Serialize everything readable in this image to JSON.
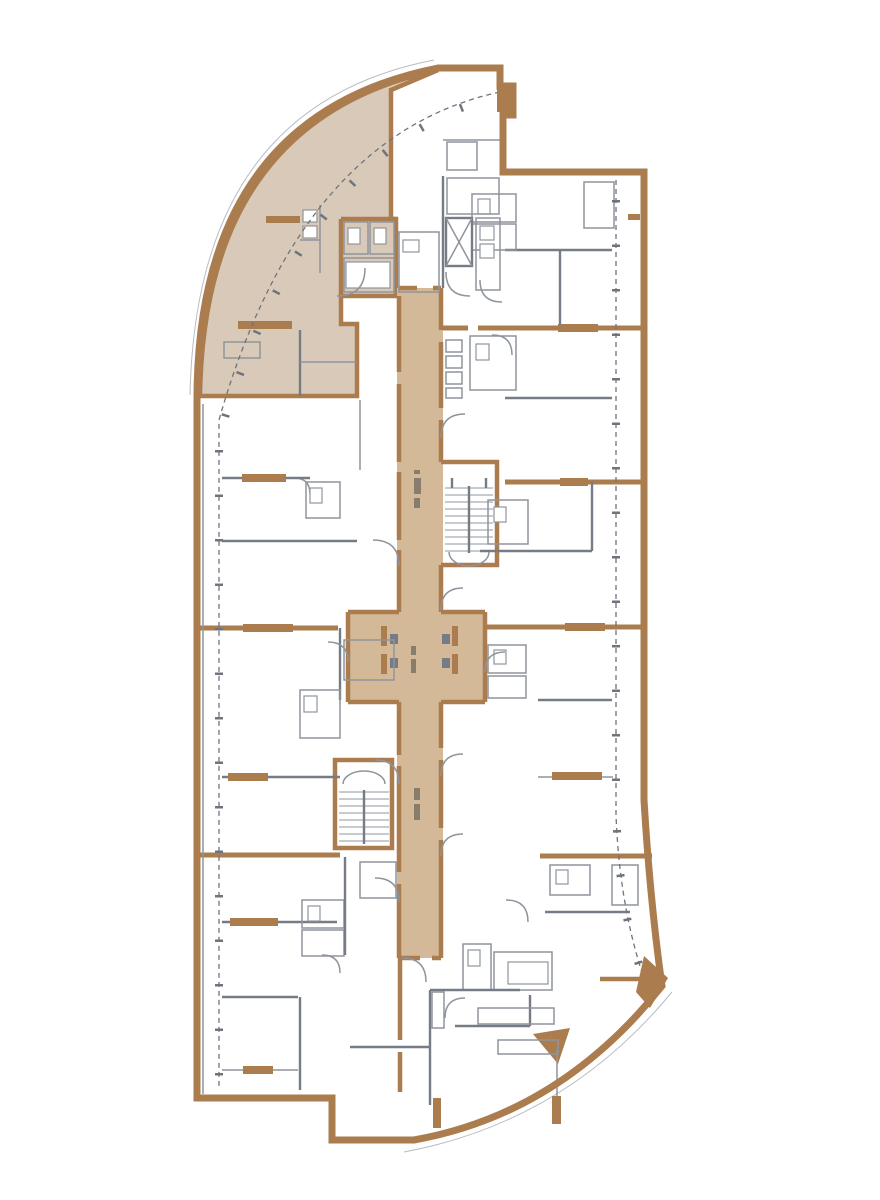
{
  "document": {
    "kind": "architectural-floor-plan",
    "visible_text": "none (only tiny illegible rotated dimension annotations in corridor)",
    "annotations": [
      "illegible micro-label in upper corridor",
      "illegible micro-label in elevator lobby",
      "illegible micro-label in lower corridor"
    ]
  },
  "colors": {
    "wall": "#ab7c4e",
    "unit": "#d9c9b8",
    "corridor": "#d3b998",
    "line": "#8f949c",
    "linedark": "#767c86",
    "linelight": "#b9bdc3",
    "dash": "#6f747c",
    "bg": "#ffffff"
  },
  "plan": {
    "highlighted_unit": "upper-left crescent corner unit (tan shaded)",
    "circulation": [
      "central corridor (tan)",
      "elevator lobby (tan)",
      "upper stairwell",
      "lower stairwell"
    ],
    "envelope": [
      "curved left/top facade",
      "straight right facade",
      "curved bottom-right facade",
      "dashed balcony glazing lines"
    ]
  }
}
